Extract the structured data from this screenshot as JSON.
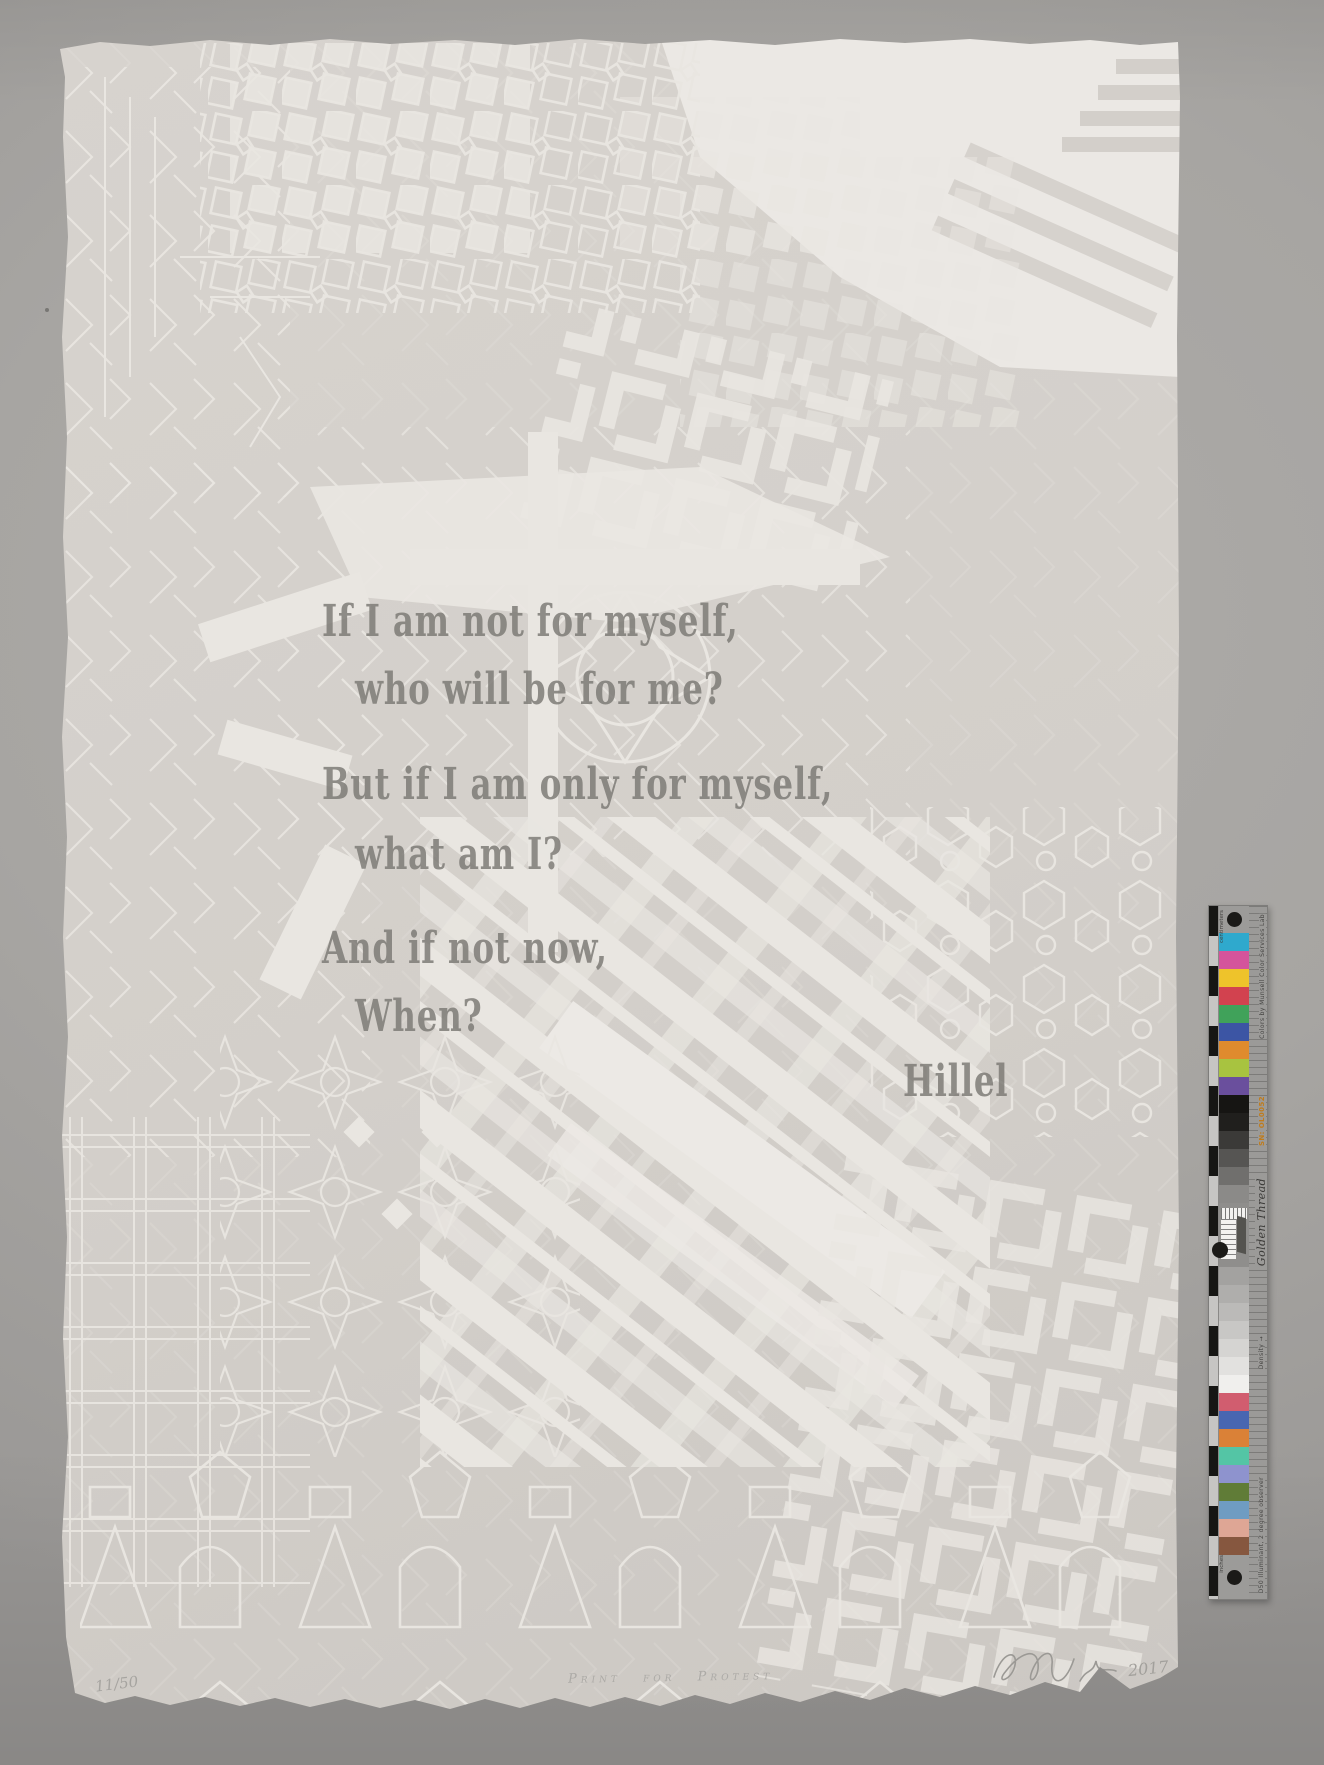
{
  "photo": {
    "backdrop_color": "#a7a5a2",
    "paper_color": "#d3cfca",
    "pattern_color": "#e9e6e1",
    "printed_text_color": "#7a7873",
    "pencil_color": "#a6a4a0"
  },
  "print": {
    "quote_lines": [
      "If I am not for myself,",
      "who will be for me?",
      "But if I am only for myself,",
      "what am I?",
      "And if not now,",
      "When?"
    ],
    "attribution": "Hillel",
    "inscriptions": {
      "edition": "11/50",
      "title": "Print for Protest",
      "date": "2017"
    }
  },
  "calibration_target": {
    "brand": "Golden Thread",
    "maker": "Colors by Munsell Color Services Lab",
    "serial": "SN: OL0052",
    "illuminant": "D50 Illuminant, 2 degree observer",
    "density_label": "Density →",
    "scale_top": "centimeters",
    "scale_bottom": "inches",
    "top_colors": [
      "#2fa9cd",
      "#d4549b",
      "#eec32b",
      "#d2424f",
      "#40a25a",
      "#3c55a4",
      "#df8b2e",
      "#a8c340",
      "#6a4f9d"
    ],
    "dark_grays": [
      "#161513",
      "#201f1d",
      "#3b3a38",
      "#565553",
      "#706f6d",
      "#8b8a88"
    ],
    "light_grays": [
      "#a3a2a0",
      "#afaeac",
      "#bbbab8",
      "#c8c7c5",
      "#d5d4d2",
      "#e2e1df",
      "#f0efed"
    ],
    "bottom_colors": [
      "#d15d6f",
      "#4866b1",
      "#da8137",
      "#54c5a5",
      "#8e93ce",
      "#607c37",
      "#6f9cc2",
      "#dea695",
      "#86573f"
    ]
  }
}
